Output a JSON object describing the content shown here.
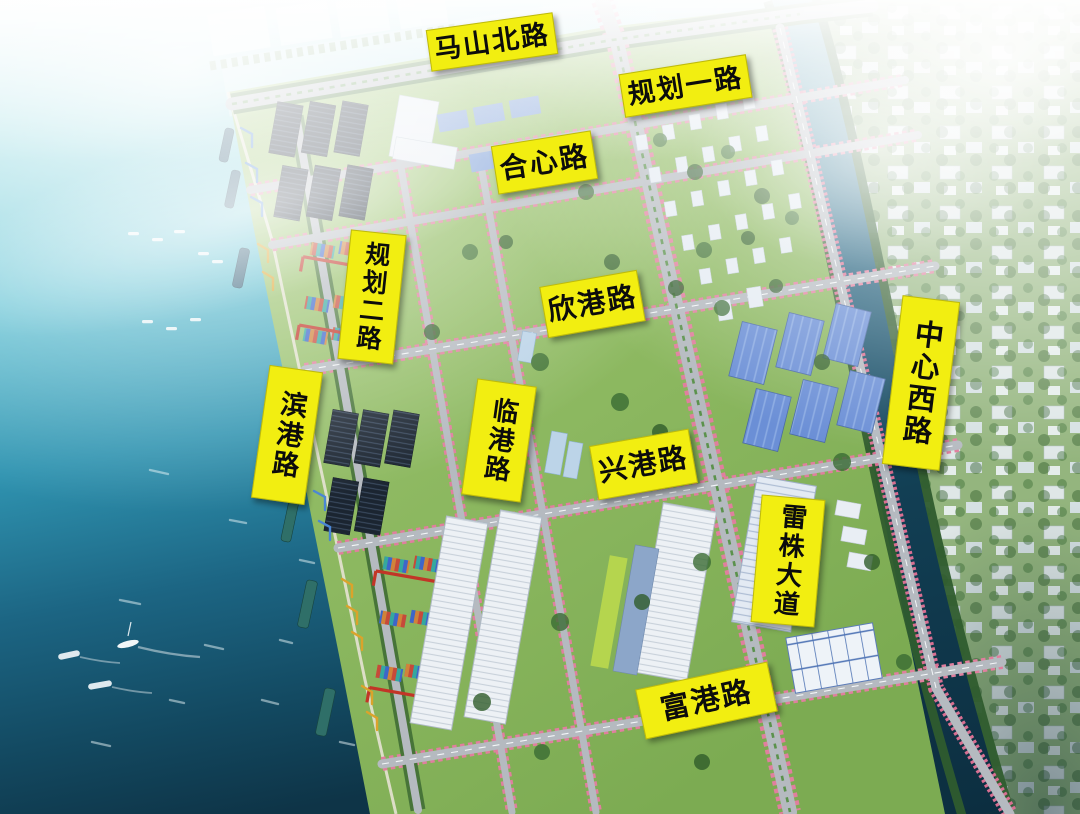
{
  "map": {
    "description": "aerial-3d-planning-rendering-of-port-industrial-park",
    "road_labels": [
      {
        "id": "mashan-north-road",
        "text": "马山北路",
        "orientation": "horizontal"
      },
      {
        "id": "guihua-road-1",
        "text": "规划一路",
        "orientation": "horizontal"
      },
      {
        "id": "hexin-road",
        "text": "合心路",
        "orientation": "horizontal"
      },
      {
        "id": "guihua-road-2",
        "text": "规划二路",
        "orientation": "vertical"
      },
      {
        "id": "xingang-road",
        "text": "欣港路",
        "orientation": "horizontal"
      },
      {
        "id": "center-west-road",
        "text": "中心西路",
        "orientation": "vertical"
      },
      {
        "id": "bingang-road",
        "text": "滨港路",
        "orientation": "vertical"
      },
      {
        "id": "lingang-road",
        "text": "临港路",
        "orientation": "vertical"
      },
      {
        "id": "xinggang-road",
        "text": "兴港路",
        "orientation": "horizontal"
      },
      {
        "id": "leizhu-avenue",
        "text": "雷株大道",
        "orientation": "vertical"
      },
      {
        "id": "fugang-road",
        "text": "富港路",
        "orientation": "horizontal"
      }
    ],
    "colors": {
      "label_bg": "#f2ee11",
      "label_text": "#0c0c0c",
      "sea_light": "#cdeef1",
      "sea_deep": "#0e3447",
      "land_green": "#8fbc63",
      "river": "#123f54",
      "road_gray": "#b5bac0",
      "blossom_pink": "#e07f9e",
      "tree_green": "#3a6b33",
      "solar_dark": "#1b2531",
      "warehouse_blue": "#6b8fd6"
    }
  }
}
